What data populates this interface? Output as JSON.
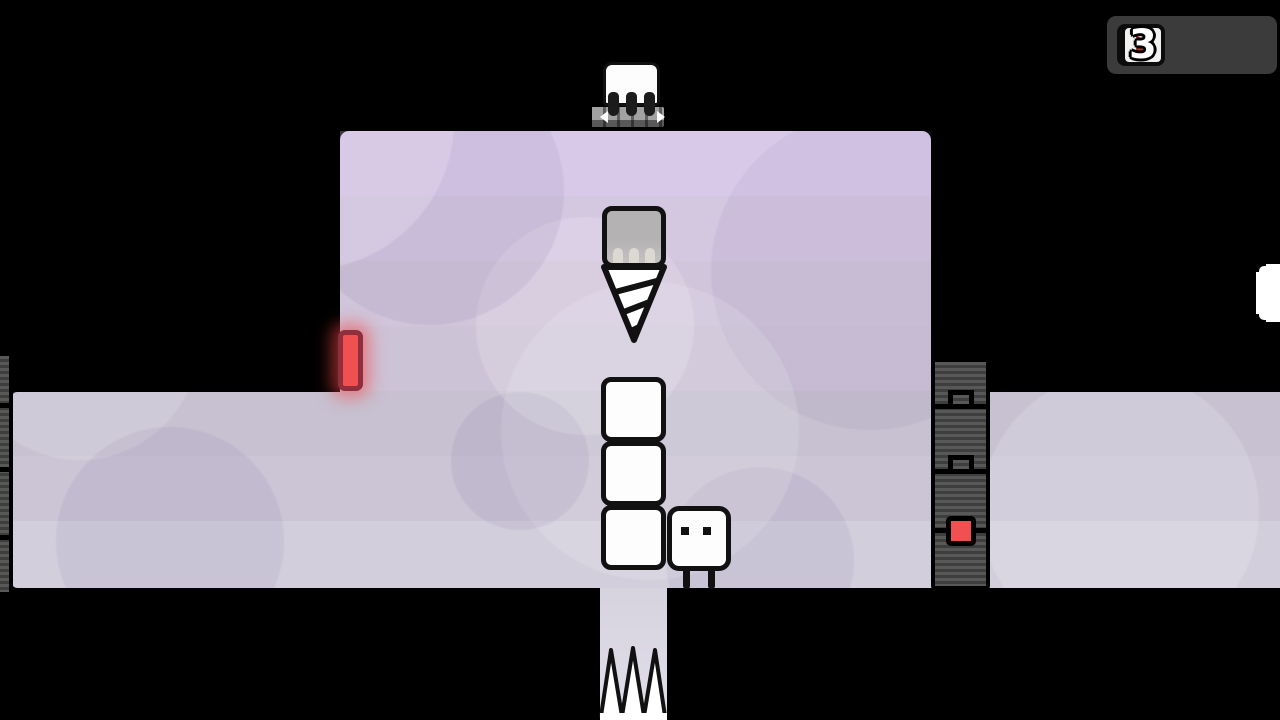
{
  "hud": {
    "counter_value": "3",
    "character_icon": "white-box-face-icon",
    "play_icon": "red-play-triangle-icon"
  },
  "scene": {
    "stacked_boxes_count": 3,
    "spikes_count": 3,
    "entities": [
      "box character with two eyes and legs",
      "vertical stack of three white boxes",
      "drill descending from ceiling track",
      "drill carrier docked on ceiling track",
      "glowing red exit door on left wall",
      "conveyor track wall with red button on right",
      "three floor spikes in pit below",
      "partially visible white box at right screen edge"
    ]
  },
  "colors": {
    "accent-red": "#f15050",
    "hud-red": "#cb2727",
    "door-frame": "#8f2e3d",
    "hud-panel": "#3b3b3b",
    "box-white": "#fdfdfd",
    "drill-gray": "#b5b2b3",
    "band1": "#d9c9e8",
    "band2": "#d4c7e0",
    "band3": "#d0c5da",
    "band4": "#cdc3d6",
    "band5": "#c7c1d1",
    "band6": "#cbc5d5",
    "band7": "#d2cedc",
    "shaft-top": "#d6d3df",
    "shaft-bottom": "#e1dee9"
  }
}
